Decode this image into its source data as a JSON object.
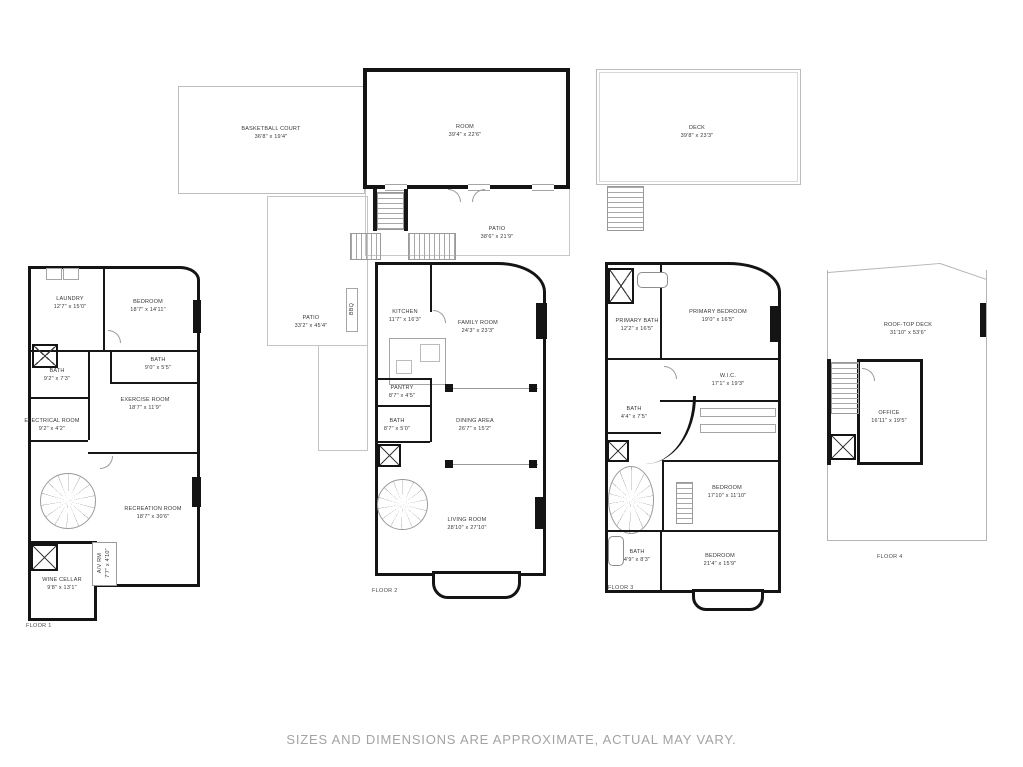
{
  "top": {
    "basketball_court": {
      "name": "BASKETBALL COURT",
      "dims": "36'8\" x 19'4\""
    },
    "room": {
      "name": "ROOM",
      "dims": "39'4\" x 22'6\""
    },
    "deck": {
      "name": "DECK",
      "dims": "39'8\" x 23'3\""
    },
    "patio": {
      "name": "PATIO",
      "dims": "38'6\" x 21'9\""
    }
  },
  "floor1": {
    "label": "FLOOR 1",
    "laundry": {
      "name": "LAUNDRY",
      "dims": "12'7\" x 15'0\""
    },
    "bedroom": {
      "name": "BEDROOM",
      "dims": "18'7\" x 14'11\""
    },
    "bath_hall": {
      "name": "BATH",
      "dims": "9'0\" x 5'5\""
    },
    "bath": {
      "name": "BATH",
      "dims": "9'2\" x 7'3\""
    },
    "electrical": {
      "name": "ELECTRICAL ROOM",
      "dims": "9'2\" x 4'2\""
    },
    "exercise": {
      "name": "EXERCISE ROOM",
      "dims": "18'7\" x 11'9\""
    },
    "recreation": {
      "name": "RECREATION ROOM",
      "dims": "18'7\" x 30'6\""
    },
    "av": {
      "name": "A/V RM",
      "dims": "7'7\" x 4'10\""
    },
    "wine": {
      "name": "WINE CELLAR",
      "dims": "9'8\" x 13'1\""
    }
  },
  "floor2": {
    "label": "FLOOR 2",
    "patio": {
      "name": "PATIO",
      "dims": "33'2\" x 45'4\""
    },
    "bbq": {
      "name": "BBQ"
    },
    "kitchen": {
      "name": "KITCHEN",
      "dims": "11'7\" x 16'3\""
    },
    "family": {
      "name": "FAMILY ROOM",
      "dims": "24'3\" x 23'3\""
    },
    "pantry": {
      "name": "PANTRY",
      "dims": "8'7\" x 4'5\""
    },
    "bath": {
      "name": "BATH",
      "dims": "8'7\" x 5'0\""
    },
    "dining": {
      "name": "DINING AREA",
      "dims": "26'7\" x 15'2\""
    },
    "living": {
      "name": "LIVING ROOM",
      "dims": "28'10\" x 27'10\""
    }
  },
  "floor3": {
    "label": "FLOOR 3",
    "primary_bath": {
      "name": "PRIMARY BATH",
      "dims": "12'2\" x 16'5\""
    },
    "primary_bedroom": {
      "name": "PRIMARY BEDROOM",
      "dims": "19'0\" x 16'5\""
    },
    "wic": {
      "name": "W.I.C.",
      "dims": "17'1\" x 19'3\""
    },
    "bath_upper": {
      "name": "BATH",
      "dims": "4'4\" x 7'5\""
    },
    "bedroom_mid": {
      "name": "BEDROOM",
      "dims": "17'10\" x 11'10\""
    },
    "bath_lower": {
      "name": "BATH",
      "dims": "4'9\" x 8'3\""
    },
    "bedroom_lower": {
      "name": "BEDROOM",
      "dims": "21'4\" x 15'9\""
    }
  },
  "floor4": {
    "label": "FLOOR 4",
    "rooftop": {
      "name": "ROOF-TOP DECK",
      "dims": "31'10\" x 53'6\""
    },
    "office": {
      "name": "OFFICE",
      "dims": "16'11\" x 19'5\""
    }
  },
  "footer": {
    "disclaimer": "SIZES AND DIMENSIONS ARE APPROXIMATE, ACTUAL MAY VARY."
  },
  "colors": {
    "wall": "#141414",
    "thin_outline": "#b5b5b5",
    "label_text": "#383838",
    "disclaimer_text": "#a3a3a3"
  }
}
